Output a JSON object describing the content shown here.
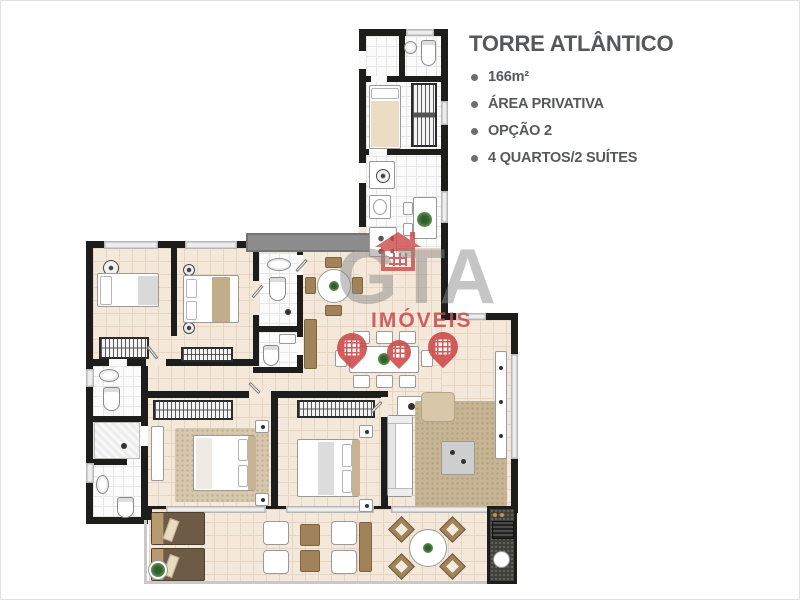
{
  "info_panel": {
    "title": "TORRE ATLÂNTICO",
    "bullets": [
      "166m²",
      "ÁREA PRIVATIVA",
      "OPÇÃO 2",
      "4 QUARTOS/2 SUÍTES"
    ]
  },
  "watermark": {
    "brand": "GTA",
    "sub": "IMÓVEIS"
  },
  "colors": {
    "wall": "#1d1d1b",
    "floor": "#f4e8da",
    "floor_grid": "#e5d5c1",
    "tile": "#fbfbfb",
    "tile_grid": "#e6e6e6",
    "window": "#ededed",
    "planter": "#8d8d8d",
    "rug": "#c7b493",
    "wood": "#a08359",
    "dark_wood": "#6e5b45",
    "granite": "#3e3e3a",
    "railing": "#c9c9c9",
    "text": "#57585a",
    "watermark_gray": "#8c8c8c",
    "accent_red": "#cd4848"
  }
}
